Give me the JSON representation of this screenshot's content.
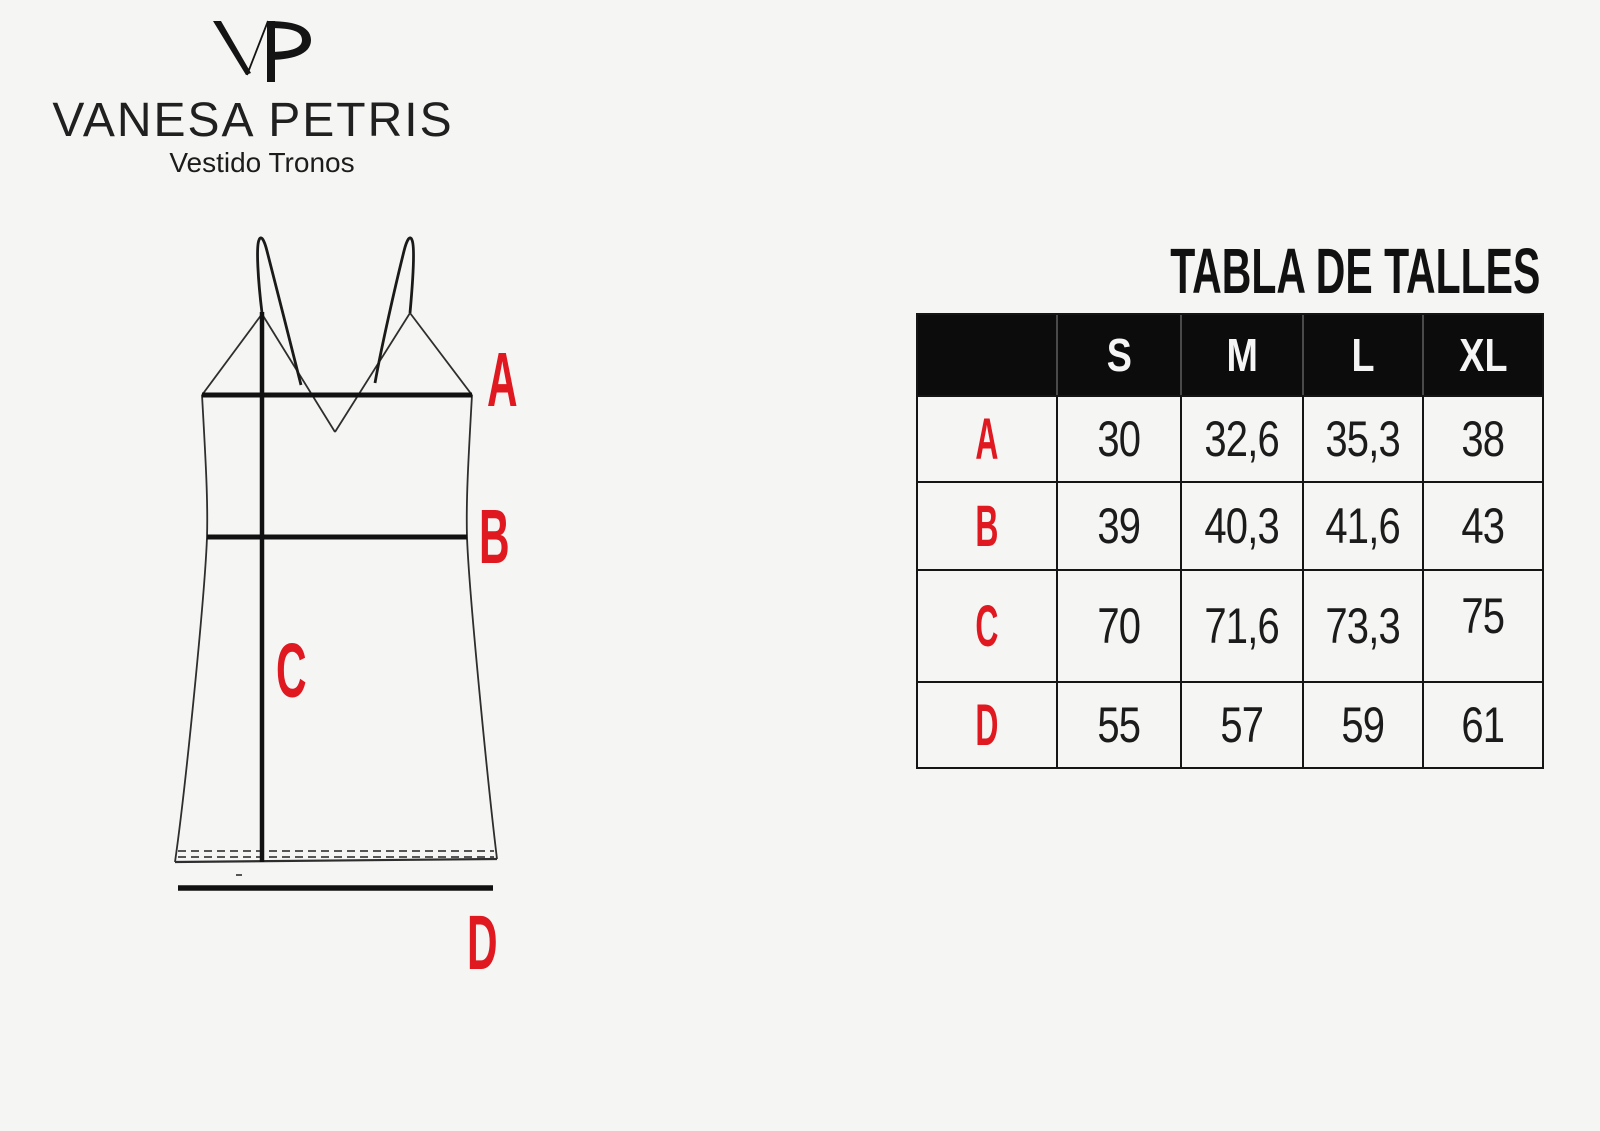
{
  "page": {
    "background": "#f5f5f3"
  },
  "colors": {
    "accent_red": "#e01820",
    "line_black": "#161616",
    "table_border": "#151515",
    "header_bg": "#0c0c0c",
    "header_divider": "#4a4a4a",
    "text_dark": "#1b1b1b",
    "text_white": "#f5f5f5"
  },
  "brand": {
    "monogram": "VP",
    "name": "VANESA PETRIS",
    "product": "Vestido Tronos"
  },
  "diagram": {
    "measure_labels": {
      "a": "A",
      "b": "B",
      "c": "C",
      "d": "D"
    }
  },
  "size_table": {
    "title": "TABLA DE TALLES",
    "columns": [
      "S",
      "M",
      "L",
      "XL"
    ],
    "rows": [
      {
        "label": "A",
        "values": [
          "30",
          "32,6",
          "35,3",
          "38"
        ]
      },
      {
        "label": "B",
        "values": [
          "39",
          "40,3",
          "41,6",
          "43"
        ]
      },
      {
        "label": "C",
        "values": [
          "70",
          "71,6",
          "73,3",
          "75"
        ]
      },
      {
        "label": "D",
        "values": [
          "55",
          "57",
          "59",
          "61"
        ]
      }
    ]
  }
}
